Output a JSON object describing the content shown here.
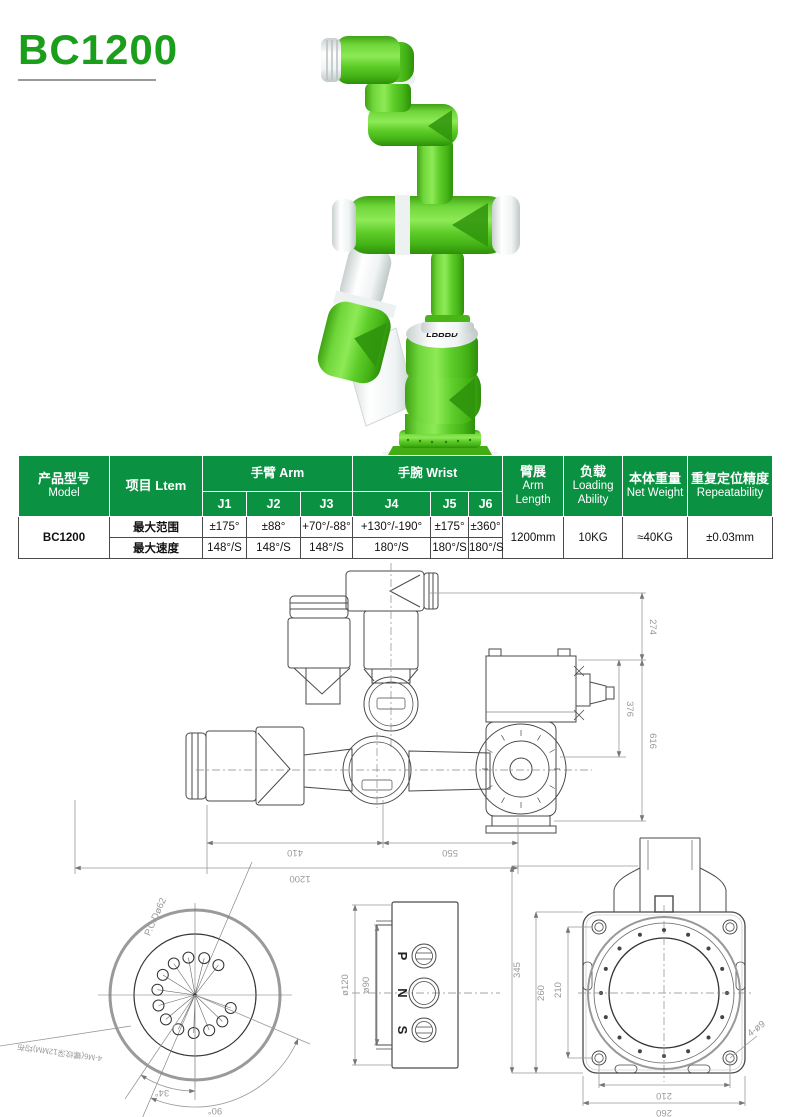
{
  "title": "BC1200",
  "robot": {
    "logo": "LBBBD"
  },
  "colors": {
    "brand_green": "#1b9e1b",
    "header_green": "#0a9142",
    "robot_green": "#5ecb2a",
    "dim_gray": "#9a9a9a"
  },
  "table": {
    "header": {
      "model_zh": "产品型号",
      "model_en": "Model",
      "item": "项目 Ltem",
      "arm_group": "手臂 Arm",
      "wrist_group": "手腕 Wrist",
      "joints": [
        "J1",
        "J2",
        "J3",
        "J4",
        "J5",
        "J6"
      ],
      "reach_zh": "臂展",
      "reach_en1": "Arm",
      "reach_en2": "Length",
      "load_zh": "负载",
      "load_en1": "Loading",
      "load_en2": "Ability",
      "weight_zh": "本体重量",
      "weight_en": "Net Weight",
      "repeat_zh": "重复定位精度",
      "repeat_en": "Repeatability"
    },
    "model_value": "BC1200",
    "rows": [
      {
        "item": "最大范围",
        "j1": "±175°",
        "j2": "±88°",
        "j3": "+70°/-88°",
        "j4": "+130°/-190°",
        "j5": "±175°",
        "j6": "±360°"
      },
      {
        "item": "最大速度",
        "j1": "148°/S",
        "j2": "148°/S",
        "j3": "148°/S",
        "j4": "180°/S",
        "j5": "180°/S",
        "j6": "180°/S"
      }
    ],
    "reach_value": "1200mm",
    "load_value": "10KG",
    "weight_value": "≈40KG",
    "repeat_value": "±0.03mm"
  },
  "drawings": {
    "side": {
      "d274": "274",
      "d376": "376",
      "d616": "616",
      "d410": "410",
      "d550": "550",
      "d1200": "1200"
    },
    "flange": {
      "pcd": "P.C.Dø62",
      "note": "4-M6(螺纹深12MM)均布",
      "a34": "34°",
      "a90": "90°"
    },
    "wrist": {
      "d120": "ø120",
      "d90": "ø90",
      "ports": [
        "P",
        "N",
        "S"
      ]
    },
    "base": {
      "d345": "345",
      "d260_left": "260",
      "d210_left": "210",
      "d210_bottom": "210",
      "d260_bottom": "260",
      "note": "4-ø9"
    }
  }
}
